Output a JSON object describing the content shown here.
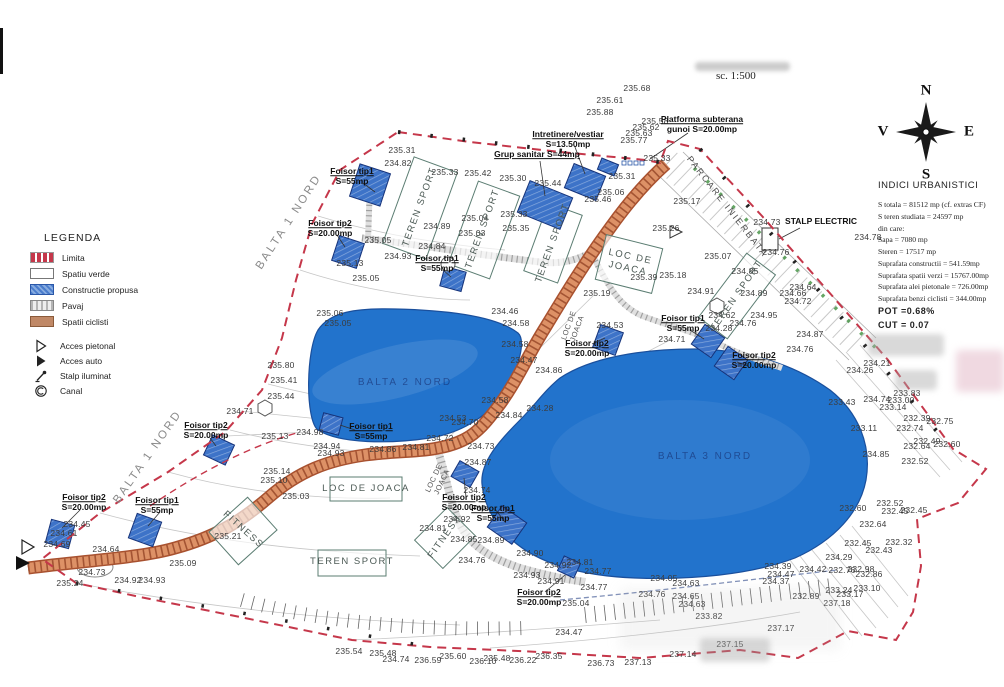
{
  "header": {
    "scale_label": "sc. 1:500"
  },
  "compass": {
    "north": "N",
    "south": "S",
    "east": "E",
    "west": "V"
  },
  "legend": {
    "title": "LEGENDA",
    "items": [
      {
        "label": "Limita",
        "icon": "limita-swatch"
      },
      {
        "label": "Spatiu verde",
        "icon": "spatiu-verde-swatch"
      },
      {
        "label": "Constructie propusa",
        "icon": "constructie-propusa-swatch"
      },
      {
        "label": "Pavaj",
        "icon": "pavaj-swatch"
      },
      {
        "label": "Spatii ciclisti",
        "icon": "spatii-ciclisti-swatch"
      },
      {
        "label": "Acces pietonal",
        "icon": "acces-pietonal-icon",
        "gap": true
      },
      {
        "label": "Acces auto",
        "icon": "acces-auto-icon"
      },
      {
        "label": "Stalp iluminat",
        "icon": "stalp-iluminat-icon"
      },
      {
        "label": "Canal",
        "icon": "canal-icon"
      }
    ]
  },
  "indici": {
    "title": "INDICI URBANISTICI",
    "lines": [
      {
        "text": "S totala  = 81512 mp (cf. extras CF)"
      },
      {
        "text": "S teren studiata = 24597 mp"
      },
      {
        "text": "din care:"
      },
      {
        "text": "Sapa = 7080 mp"
      },
      {
        "text": "Steren = 17517 mp"
      },
      {
        "text": "Suprafata constructii = 541.59mp"
      },
      {
        "text": "Suprafata spatii verzi = 15767.00mp"
      },
      {
        "text": "Suprafata alei pietonale = 726.00mp"
      },
      {
        "text": "Suprafata benzi ciclisti = 344.00mp"
      },
      {
        "text": "POT  =0.68%",
        "strong": true
      },
      {
        "text": "CUT = 0.07",
        "strong": true
      }
    ]
  },
  "colors": {
    "boundary-red": "#c5374a",
    "water-blue": "#2273cc",
    "water-edge": "#1a4f9c",
    "road-fill": "#dd9166",
    "road-edge": "#a8512f",
    "road-hatch": "#8a3b1e",
    "path-gray": "#e0e0e0",
    "path-hatch": "#8a8a8a",
    "build-blue": "#3d73c8",
    "build-edge": "#16337a",
    "field-stroke": "#5b7d72",
    "green-dots": "#3f8f3f"
  },
  "map_labels": {
    "elevations": [
      [
        "235.68",
        637,
        88
      ],
      [
        "235.61",
        610,
        100
      ],
      [
        "235.88",
        600,
        112
      ],
      [
        "235.58",
        655,
        121
      ],
      [
        "235.62",
        646,
        127
      ],
      [
        "235.63",
        639,
        133
      ],
      [
        "235.77",
        634,
        140
      ],
      [
        "235.33",
        657,
        158
      ],
      [
        "235.31",
        622,
        176
      ],
      [
        "235.06",
        611,
        192
      ],
      [
        "235.46",
        598,
        199
      ],
      [
        "235.31",
        402,
        150
      ],
      [
        "234.82",
        398,
        163
      ],
      [
        "235.33",
        445,
        172
      ],
      [
        "235.42",
        478,
        173
      ],
      [
        "235.30",
        513,
        178
      ],
      [
        "235.44",
        548,
        183
      ],
      [
        "235.17",
        687,
        201
      ],
      [
        "234.89",
        437,
        226
      ],
      [
        "235.04",
        475,
        218
      ],
      [
        "235.03",
        472,
        233
      ],
      [
        "235.33",
        514,
        214
      ],
      [
        "235.35",
        516,
        228
      ],
      [
        "235.05",
        378,
        240
      ],
      [
        "234.84",
        432,
        246
      ],
      [
        "234.93",
        398,
        256
      ],
      [
        "235.13",
        350,
        263
      ],
      [
        "235.05",
        366,
        278
      ],
      [
        "235.26",
        666,
        228
      ],
      [
        "234.73",
        767,
        222
      ],
      [
        "234.78",
        868,
        237
      ],
      [
        "234.76",
        776,
        252
      ],
      [
        "235.07",
        718,
        256
      ],
      [
        "234.85",
        745,
        271
      ],
      [
        "234.64",
        803,
        287
      ],
      [
        "234.66",
        793,
        293
      ],
      [
        "234.72",
        798,
        301
      ],
      [
        "234.87",
        810,
        334
      ],
      [
        "234.76",
        800,
        349
      ],
      [
        "235.18",
        673,
        275
      ],
      [
        "235.39",
        644,
        277
      ],
      [
        "235.19",
        597,
        293
      ],
      [
        "234.91",
        701,
        291
      ],
      [
        "234.89",
        754,
        293
      ],
      [
        "234.62",
        722,
        315
      ],
      [
        "234.95",
        764,
        315
      ],
      [
        "234.76",
        743,
        323
      ],
      [
        "234.28",
        719,
        328
      ],
      [
        "234.71",
        672,
        339
      ],
      [
        "234.53",
        610,
        325
      ],
      [
        "234.46",
        505,
        311
      ],
      [
        "234.58",
        516,
        323
      ],
      [
        "234.58",
        515,
        344
      ],
      [
        "234.47",
        524,
        360
      ],
      [
        "234.86",
        549,
        370
      ],
      [
        "234.58",
        495,
        400
      ],
      [
        "234.70",
        465,
        422
      ],
      [
        "234.53",
        453,
        418
      ],
      [
        "234.72",
        440,
        438
      ],
      [
        "234.28",
        540,
        408
      ],
      [
        "234.84",
        509,
        415
      ],
      [
        "234.21",
        877,
        363
      ],
      [
        "234.26",
        860,
        370
      ],
      [
        "233.83",
        907,
        393
      ],
      [
        "234.74",
        877,
        399
      ],
      [
        "233.00",
        901,
        400
      ],
      [
        "233.14",
        893,
        407
      ],
      [
        "233.43",
        842,
        402
      ],
      [
        "232.39",
        917,
        418
      ],
      [
        "232.75",
        940,
        421
      ],
      [
        "232.74",
        910,
        428
      ],
      [
        "233.11",
        864,
        428
      ],
      [
        "232.49",
        927,
        441
      ],
      [
        "232.60",
        947,
        444
      ],
      [
        "232.64",
        917,
        446
      ],
      [
        "232.52",
        915,
        461
      ],
      [
        "234.85",
        876,
        454
      ],
      [
        "232.60",
        853,
        508
      ],
      [
        "232.52",
        890,
        503
      ],
      [
        "232.45",
        895,
        511
      ],
      [
        "232.45",
        914,
        510
      ],
      [
        "232.64",
        873,
        524
      ],
      [
        "232.45",
        858,
        543
      ],
      [
        "232.32",
        899,
        542
      ],
      [
        "232.43",
        879,
        550
      ],
      [
        "234.29",
        839,
        557
      ],
      [
        "234.42",
        813,
        569
      ],
      [
        "232.76",
        842,
        570
      ],
      [
        "232.98",
        861,
        569
      ],
      [
        "232.86",
        869,
        574
      ],
      [
        "233.10",
        867,
        588
      ],
      [
        "233.24",
        839,
        590
      ],
      [
        "233.17",
        850,
        594
      ],
      [
        "232.89",
        806,
        596
      ],
      [
        "237.18",
        837,
        603
      ],
      [
        "234.39",
        778,
        566
      ],
      [
        "234.47",
        781,
        574
      ],
      [
        "234.37",
        776,
        581
      ],
      [
        "235.06",
        330,
        313
      ],
      [
        "235.05",
        338,
        323
      ],
      [
        "235.80",
        281,
        365
      ],
      [
        "235.41",
        284,
        380
      ],
      [
        "235.44",
        281,
        396
      ],
      [
        "234.71",
        240,
        411
      ],
      [
        "235.13",
        275,
        436
      ],
      [
        "234.98",
        310,
        432
      ],
      [
        "234.94",
        327,
        446
      ],
      [
        "234.93",
        331,
        453
      ],
      [
        "234.86",
        383,
        449
      ],
      [
        "234.81",
        416,
        447
      ],
      [
        "234.73",
        481,
        446
      ],
      [
        "234.87",
        478,
        462
      ],
      [
        "234.74",
        477,
        490
      ],
      [
        "235.14",
        277,
        471
      ],
      [
        "235.10",
        274,
        480
      ],
      [
        "235.03",
        296,
        496
      ],
      [
        "234.45",
        77,
        524
      ],
      [
        "234.61",
        64,
        533
      ],
      [
        "234.69",
        57,
        544
      ],
      [
        "234.64",
        106,
        549
      ],
      [
        "234.73",
        92,
        572
      ],
      [
        "234.92",
        128,
        580
      ],
      [
        "234.93",
        152,
        580
      ],
      [
        "235.24",
        70,
        583
      ],
      [
        "235.09",
        183,
        563
      ],
      [
        "235.21",
        228,
        536
      ],
      [
        "234.92",
        457,
        519
      ],
      [
        "234.81",
        433,
        528
      ],
      [
        "234.85",
        464,
        539
      ],
      [
        "234.89",
        491,
        540
      ],
      [
        "234.90",
        530,
        553
      ],
      [
        "234.76",
        472,
        560
      ],
      [
        "234.93",
        527,
        575
      ],
      [
        "234.91",
        551,
        581
      ],
      [
        "234.92",
        558,
        565
      ],
      [
        "234.81",
        580,
        562
      ],
      [
        "234.77",
        598,
        571
      ],
      [
        "234.77",
        594,
        587
      ],
      [
        "235.04",
        576,
        603
      ],
      [
        "234.76",
        652,
        594
      ],
      [
        "234.65",
        686,
        596
      ],
      [
        "234.63",
        692,
        604
      ],
      [
        "233.82",
        709,
        616
      ],
      [
        "234.05",
        664,
        578
      ],
      [
        "234.63",
        686,
        583
      ],
      [
        "234.47",
        569,
        632
      ],
      [
        "236.22",
        523,
        660
      ],
      [
        "236.35",
        549,
        656
      ],
      [
        "236.73",
        601,
        663
      ],
      [
        "237.13",
        638,
        662
      ],
      [
        "237.14",
        683,
        654
      ],
      [
        "237.15",
        730,
        644
      ],
      [
        "237.17",
        781,
        628
      ],
      [
        "235.54",
        349,
        651
      ],
      [
        "235.48",
        383,
        653
      ],
      [
        "234.74",
        396,
        659
      ],
      [
        "236.59",
        428,
        660
      ],
      [
        "235.60",
        453,
        656
      ],
      [
        "236.10",
        483,
        661
      ],
      [
        "235.48",
        497,
        658
      ]
    ],
    "features": [
      [
        "Foisor tip1",
        "S=55mp",
        352,
        177,
        1
      ],
      [
        "Foisor tip2",
        "S=20.00mp",
        330,
        229,
        1
      ],
      [
        "Foisor tip1",
        "S=55mp",
        437,
        264,
        1
      ],
      [
        "Grup sanitar S=44mp",
        "",
        537,
        155,
        1
      ],
      [
        "Intretinere/vestiar",
        "S=13.50mp",
        568,
        140,
        1
      ],
      [
        "Platforma subterana",
        "gunoi S=20.00mp",
        702,
        125,
        1
      ],
      [
        "STALP ELECTRIC",
        "",
        821,
        222,
        0
      ],
      [
        "Foisor tip2",
        "S=20.00mp",
        206,
        431,
        1
      ],
      [
        "Foisor tip2",
        "S=20.00mp",
        84,
        503,
        1
      ],
      [
        "Foisor tip1",
        "S=55mp",
        157,
        506,
        1
      ],
      [
        "Foisor tip1",
        "S=55mp",
        371,
        432,
        1
      ],
      [
        "Foisor tip2",
        "S=20.00mp",
        464,
        503,
        1
      ],
      [
        "Foisor tip1",
        "S=55mp",
        493,
        514,
        1
      ],
      [
        "Foisor tip2",
        "S=20.00mp",
        539,
        598,
        1
      ],
      [
        "Foisor tip2",
        "S=20.00mp",
        587,
        349,
        1
      ],
      [
        "Foisor tip1",
        "S=55mp",
        683,
        324,
        1
      ],
      [
        "Foisor tip2",
        "S=20.00mp",
        754,
        361,
        1
      ]
    ],
    "areas": [
      [
        "TEREN SPORT",
        420,
        207,
        -70,
        ""
      ],
      [
        "TEREN SPORT",
        483,
        229,
        -70,
        ""
      ],
      [
        "TEREN SPORT",
        553,
        243,
        -70,
        ""
      ],
      [
        "TEREN SPORT",
        737,
        296,
        -55,
        ""
      ],
      [
        "LOC DE\nJOACA",
        629,
        263,
        12,
        ""
      ],
      [
        "LOC DE JOACA",
        366,
        489,
        0,
        ""
      ],
      [
        "LOC DE\nJOACA",
        573,
        327,
        -70,
        "small"
      ],
      [
        "LOC DE\nJOACA",
        438,
        480,
        -65,
        "small"
      ],
      [
        "FITNESS",
        243,
        530,
        42,
        ""
      ],
      [
        "FITNESS",
        445,
        537,
        -55,
        ""
      ],
      [
        "TEREN SPORT",
        352,
        562,
        0,
        ""
      ],
      [
        "BALTA 1 NORD",
        289,
        222,
        -57,
        "big"
      ],
      [
        "BALTA 1 NORD",
        148,
        457,
        -55,
        "big"
      ],
      [
        "BALTA 2 NORD",
        405,
        383,
        0,
        "water"
      ],
      [
        "BALTA 3 NORD",
        705,
        457,
        0,
        "water"
      ],
      [
        "PARCARE INIERBATA",
        727,
        207,
        52,
        "parcare"
      ]
    ]
  }
}
